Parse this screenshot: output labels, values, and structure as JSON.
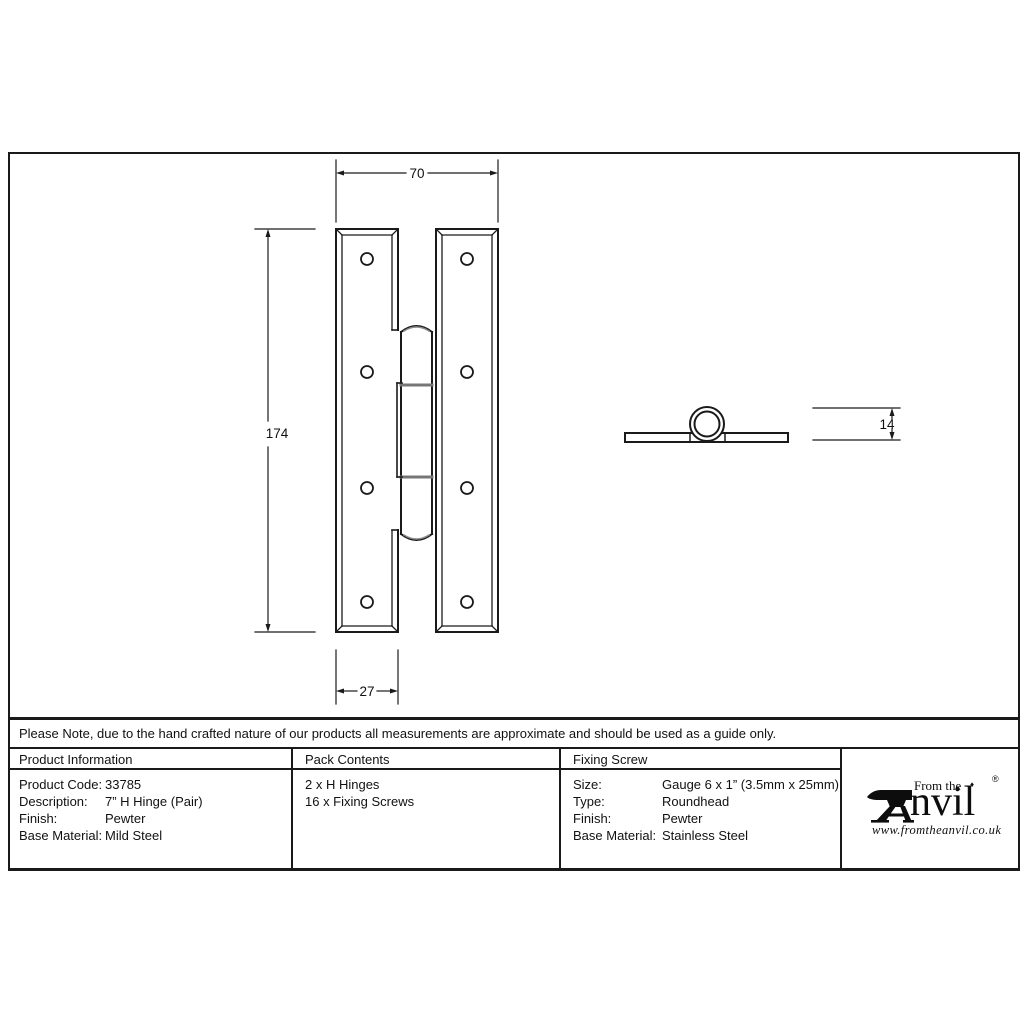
{
  "note": {
    "text": "Please Note, due to the hand crafted nature of our products all measurements are approximate and should be used as a guide only."
  },
  "drawing": {
    "dims": {
      "width": "70",
      "height": "174",
      "leaf_width": "27",
      "thickness": "14"
    }
  },
  "table": {
    "product_info": {
      "header": "Product Information",
      "rows": [
        {
          "label": "Product Code:",
          "value": "33785"
        },
        {
          "label": "Description:",
          "value": "7” H Hinge (Pair)"
        },
        {
          "label": "Finish:",
          "value": "Pewter"
        },
        {
          "label": "Base Material:",
          "value": "Mild Steel"
        }
      ]
    },
    "pack_contents": {
      "header": "Pack Contents",
      "items": [
        "2 x H Hinges",
        "16 x Fixing Screws"
      ]
    },
    "fixing_screw": {
      "header": "Fixing Screw",
      "rows": [
        {
          "label": "Size:",
          "value": "Gauge 6 x 1” (3.5mm x 25mm)"
        },
        {
          "label": "Type:",
          "value": "Roundhead"
        },
        {
          "label": "Finish:",
          "value": "Pewter"
        },
        {
          "label": "Base Material:",
          "value": "Stainless Steel"
        }
      ]
    }
  },
  "logo": {
    "from_the": "From the",
    "brand_rest": "nvil",
    "diamond": "♦",
    "registered": "®",
    "url": "www.fromtheanvil.co.uk"
  },
  "colors": {
    "line": "#1a1a1a",
    "joint_gray": "#767676"
  }
}
